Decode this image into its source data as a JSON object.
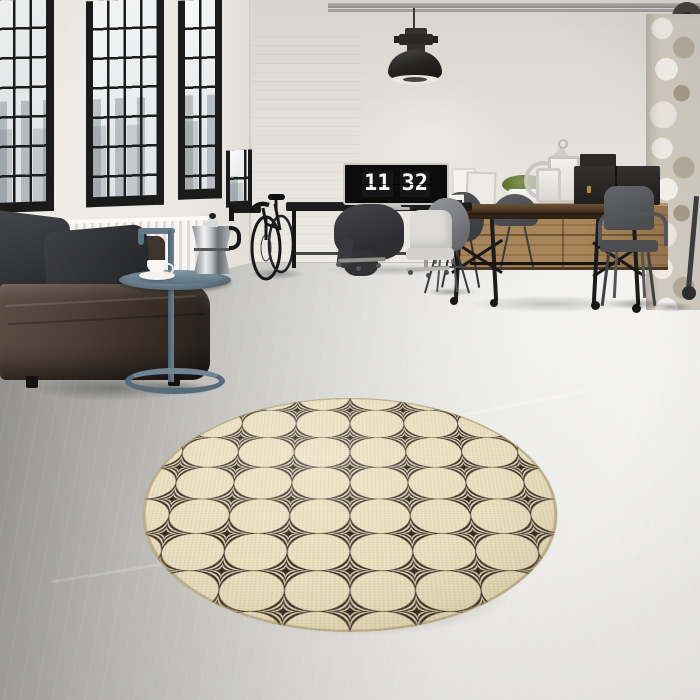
{
  "clock": {
    "hours": "11",
    "minutes": "32"
  },
  "palette": {
    "wall": "#e4e1dc",
    "floor_shadow": "#8e8d8a",
    "floor_light": "#f3f2f0",
    "window_frame": "#1b1b1b",
    "sky": "#eef1f2",
    "sofa_leather_dark": "#2f2721",
    "sofa_leather_light": "#5d4f44",
    "pillow_gray": "#3c3d41",
    "radiator_white": "#f7f6f4",
    "side_table_steel_blue": "#64788a",
    "moka_chrome": "#d9dcde",
    "rug_beige": "#e8ddbc",
    "rug_black": "#2b2118",
    "wood_oak": "#a8855a",
    "table_wood_dark": "#523c28",
    "metal_chair_gray": "#55575b",
    "lamp_black": "#1f1f1f",
    "box_brass": "#ad8a35"
  }
}
